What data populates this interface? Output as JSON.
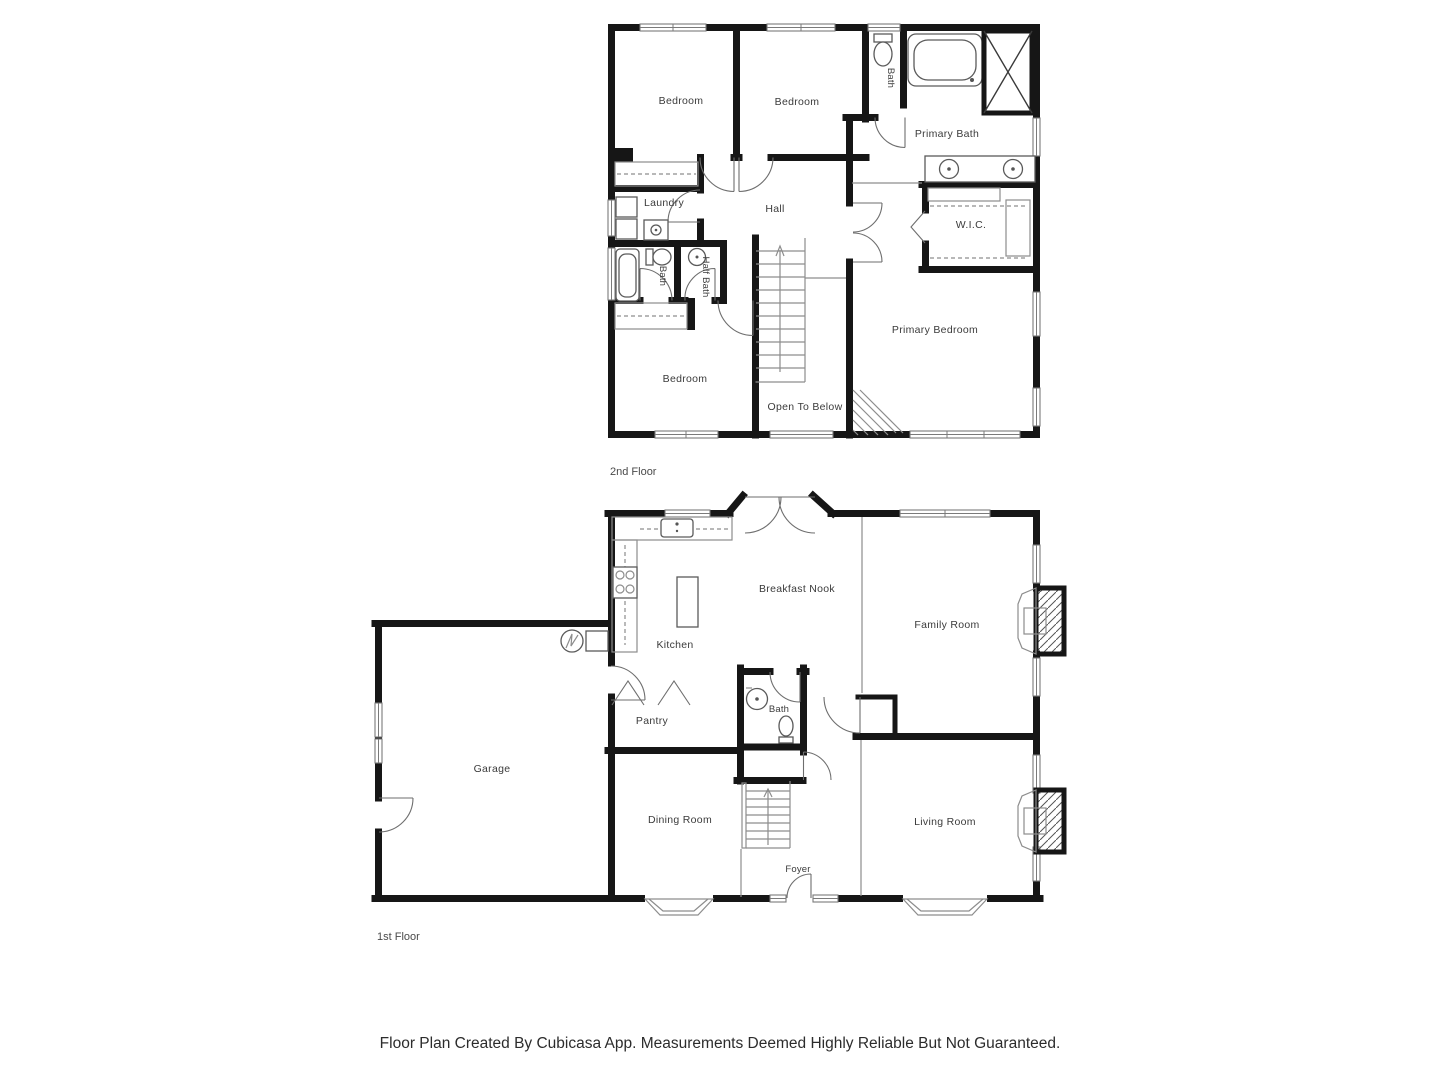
{
  "footer": "Floor Plan Created By Cubicasa App. Measurements Deemed Highly Reliable But Not Guaranteed.",
  "floors": {
    "second": {
      "name": "2nd Floor",
      "rooms": {
        "bedroom_a": "Bedroom",
        "bedroom_b": "Bedroom",
        "bath_top": "Bath",
        "primary_bath": "Primary Bath",
        "laundry": "Laundry",
        "hall": "Hall",
        "wic": "W.I.C.",
        "bath_mid": "Bath",
        "half_bath": "Half Bath",
        "bedroom_c": "Bedroom",
        "open_to_below": "Open To Below",
        "primary_bedroom": "Primary Bedroom"
      }
    },
    "first": {
      "name": "1st Floor",
      "rooms": {
        "kitchen": "Kitchen",
        "breakfast_nook": "Breakfast Nook",
        "family_room": "Family Room",
        "pantry": "Pantry",
        "bath": "Bath",
        "garage": "Garage",
        "dining_room": "Dining Room",
        "living_room": "Living Room",
        "foyer": "Foyer"
      }
    }
  },
  "colors": {
    "wall": "#161616",
    "label": "#3b3b3b",
    "fixture": "#5a5a5a"
  }
}
